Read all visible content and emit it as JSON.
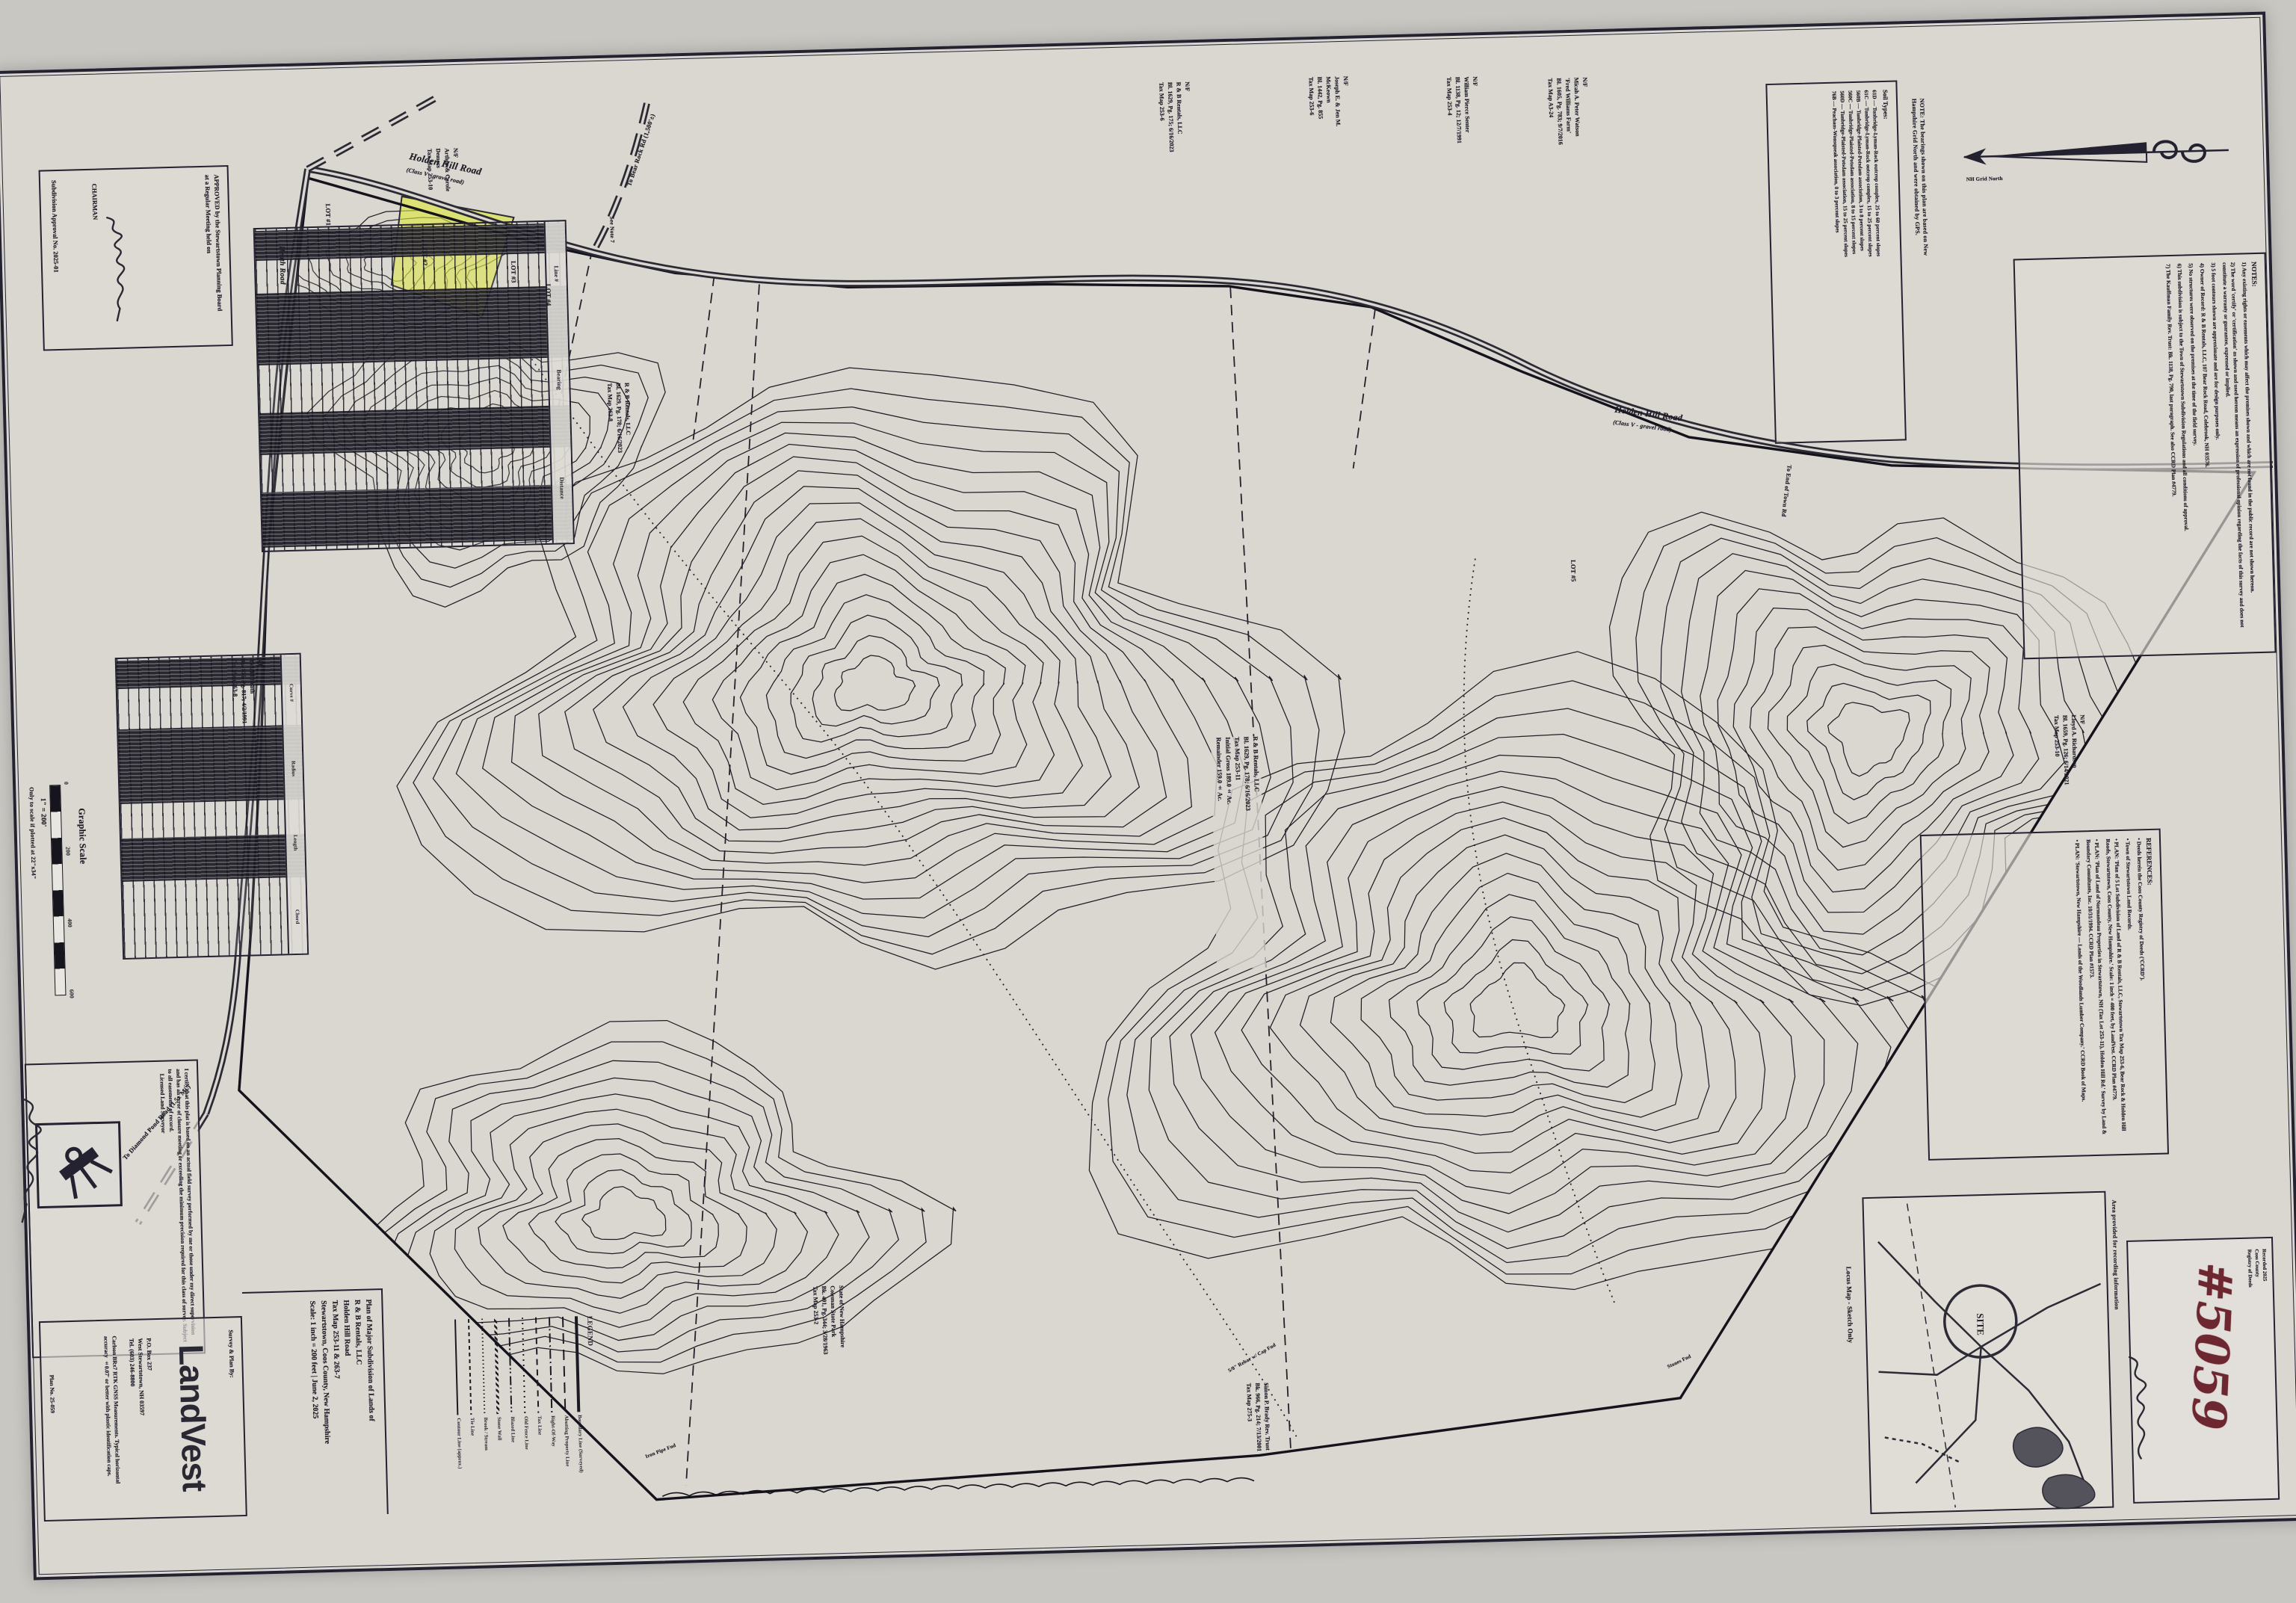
{
  "sheet": {
    "paper_color": "#dad7d1",
    "ink_color": "#201e28",
    "highlight_yellow": "#dde73a",
    "stamp_red": "#6d2730"
  },
  "approval": {
    "line1": "APPROVED by the Stewartstown Planning Board",
    "line2": "at a Regular Meeting held on",
    "chairman_label": "CHAIRMAN",
    "approval_no": "Subdivision Approval No. 2025-01"
  },
  "line_table": {
    "title": "Line Table",
    "headers": [
      "Line #",
      "Bearing",
      "Distance"
    ]
  },
  "curve_table": {
    "title": "Curve Table",
    "headers": [
      "Curve #",
      "Radius",
      "Length",
      "Chord"
    ]
  },
  "graphic_scale": {
    "title": "Graphic Scale",
    "ratio": "1\" = 200'",
    "note": "Only to scale if plotted at 22\"x34\"",
    "ticks": [
      "0",
      "200",
      "400",
      "600"
    ]
  },
  "certification": {
    "text": "I certify that this plat is based on an actual field survey performed by me or those under my direct supervision and has an error of closure meeting or exceeding the minimum precision required for this class of survey. Subject to all easements of record.",
    "surveyor_label": "Licensed Land Surveyor"
  },
  "landvest": {
    "caption": "Survey & Plan By:",
    "logo": "LandVest",
    "address": [
      "P.O. Box 237",
      "West Stewartstown, NH 03597",
      "Tel. (603) 246-8800"
    ],
    "equipment_note": "Carlson BRx7 RTK GNSS Measurements. Typical horizontal accuracy ±0.07' or better with plastic identification caps.",
    "plan_no": "Plan No. 25-059"
  },
  "title_block": {
    "lines": [
      "Plan of Major Subdivision of Lands of",
      "R & B Rentals, LLC",
      "Holden Hill Road",
      "Tax Map 253-11 & 263-7",
      "Stewartstown, Coos County, New Hampshire",
      "Scale: 1 inch = 200 feet | June 2, 2025"
    ]
  },
  "legend": {
    "title": "LEGEND",
    "items": [
      {
        "label": "Boundary Line (Surveyed)",
        "style": "solid-thick"
      },
      {
        "label": "Abutting Property Line",
        "style": "dash-long"
      },
      {
        "label": "Right-Of-Way",
        "style": "dash-dot"
      },
      {
        "label": "Tax Line",
        "style": "dash-short"
      },
      {
        "label": "Old Fence Line",
        "style": "dotted"
      },
      {
        "label": "Blazed Line",
        "style": "dash-dot-dot"
      },
      {
        "label": "Stone Wall",
        "style": "wavy"
      },
      {
        "label": "Brook / Stream",
        "style": "dotted-fine"
      },
      {
        "label": "Tie Line",
        "style": "dash-tiny"
      },
      {
        "label": "Contour Line (approx.)",
        "style": "solid-thin"
      }
    ]
  },
  "locus": {
    "caption": "Locus Map - Sketch Only",
    "site_label": "SITE",
    "area_note": "Area provided for recording information"
  },
  "recording": {
    "number": "#5059",
    "stamp_lines": [
      "Recorded 2025",
      "Coos County",
      "Registry of Deeds"
    ]
  },
  "north": {
    "note": "NOTE: The bearings shown on this plan are based on New Hampshire Grid North and were obtained by GPS.",
    "arrow_label": "NH Grid North"
  },
  "soils": {
    "title": "Soil Types:",
    "rows": [
      "61D — Tunbridge-Lyman-Rock outcrop complex, 25 to 60 percent slopes",
      "61C — Tunbridge-Lyman-Rock outcrop complex, 15 to 25 percent slopes",
      "560B — Tunbridge-Plaisted-Potsdam association, 3 to 8 percent slopes",
      "560C — Tunbridge-Plaisted-Potsdam association, 8 to 15 percent slopes",
      "560D — Tunbridge-Plaisted-Potsdam association, 15 to 25 percent slopes",
      "76B — Peacham-Wonsqueak association, 0 to 3 percent slopes"
    ]
  },
  "notes": {
    "title": "NOTES:",
    "items": [
      "1) Any existing rights or easements which may affect the premises shown and which are not found in the public record are not shown hereon.",
      "2) The word 'certify' or 'certification' as shown and used hereon means an expression of professional opinion regarding the facts of this survey and does not constitute a warranty or guarantee, expressed or implied.",
      "3) 5 foot contours shown are approximate and are for design purposes only.",
      "4) Owner of Record: R & B Rentals, LLC, 107 Bear Rock Road, Colebrook, NH 03576.",
      "5) No structures were observed on the premises at the time of the field survey.",
      "6) This subdivision is subject to the Town of Stewartstown Subdivision Regulations and all conditions of approval.",
      "7) The Kauffman Family Rev. Trust: Bk. 1138, Pg. 790, last paragraph. See also CCRD Plan #4779."
    ]
  },
  "references": {
    "title": "REFERENCES:",
    "items": [
      "• Deeds herein the Coos County Registry of Deeds ('CCRD').",
      "• Town of Stewartstown Land Records.",
      "• PLAN: 'Plan of 5 Lot Subdivision of Land of R & B Rentals, LLC, Stewartstown Tax Map 253-6, Bear Rock & Holden Hill Roads, Stewartstown, Coos County, New Hampshire.' Scale: 1 inch = 400 feet, by LandVest. CCRD Plan #4779.",
      "• PLAN: 'Plan of Land of Normandeau Properties in Stewartstown, NH (Tax Lot 253-11), Holden Hill Rd.' Survey by Land & Boundary Consultants, Inc. 10/31/1994. CCRD Plan #1573.",
      "• PLAN: 'Stewartstown, New Hampshire — Lands of the Woodlands Lumber Company.' CCRD Book of Maps."
    ]
  },
  "map": {
    "roads": {
      "holden1": "Holden Hill Road",
      "holden1_sub": "(Class V - gravel road)",
      "holden2": "Holden Hill Road",
      "holden2_sub": "(Class V - gravel road)",
      "heath": "Heath Road",
      "bear_rock": "To Bear Rock Rd (1,500'±)",
      "diamond_pond": "To Diamond Pond Road (1.5± Mi.)",
      "town_end": "To End of Town Rd"
    },
    "lots": [
      "LOT #1",
      "LOT #2",
      "LOT #3",
      "LOT #4",
      "LOT #5"
    ],
    "abutters": {
      "demers": [
        "N/F",
        "Arthur & Carole",
        "Demers",
        "Tax Map 253-10"
      ],
      "rnb_253_6": [
        "N/F",
        "R & B Rentals, LLC",
        "Bl. 1629, Pg. 175; 6/16/2023",
        "Tax Map 253-6"
      ],
      "mckeown": [
        "N/F",
        "Joseph E. & Jen M.",
        "McKeown",
        "Bl. 1442, Pg. 855",
        "Tax Map 253-6"
      ],
      "senter": [
        "N/F",
        "William Pierce Senter",
        "Bl. 1138, Pg. 12; 12/7/1991",
        "Tax Map 253-4"
      ],
      "watson": [
        "N/F",
        "Micah A. Peter Watson",
        "'Fred Williams Farm'",
        "Bl. 1605, Pg. 783; 9/7/2016",
        "Tax Map A3-24"
      ],
      "richardson": [
        "N/F",
        "Lloyd A. Richardson",
        "Bl. 1659, Pg. 126; 6/14/2021",
        "Tax Map 253-10"
      ],
      "heath_owner": [
        "N/F",
        "Ronald Heath",
        "Bk. 775, Pg. 817; 4/2/1991",
        "Tax Map 263-8"
      ],
      "rnb_263_8": [
        "R & B Rentals, LLC",
        "Bl. 1629, Pg. 178; 6/16/2023",
        "Tax Map 263-8"
      ],
      "coleman": [
        "State of New Hampshire",
        "Coleman State Park",
        "Bk. 491, Pg. 344; 3/28/1963",
        "Tax Map 253-2"
      ],
      "brady": [
        "Simon P. Brady Rev. Trust",
        "Bk. 966, Pg. 214; 7/13/2001",
        "Tax Map 275-3"
      ],
      "owner_center": [
        "R & B Rentals, LLC",
        "Bl. 1629, Pg. 178; 6/16/2023",
        "Tax Map 253-11",
        "Initial Gross 189.0± Ac.",
        "Remainder 159.0± Ac."
      ]
    },
    "annotations": {
      "see_note": "See Note 7",
      "rebar": "5/8\" Rebar w/ Cap Fnd",
      "stones": "Stones Fnd",
      "iron_pipe": "Iron Pipe Fnd"
    }
  }
}
